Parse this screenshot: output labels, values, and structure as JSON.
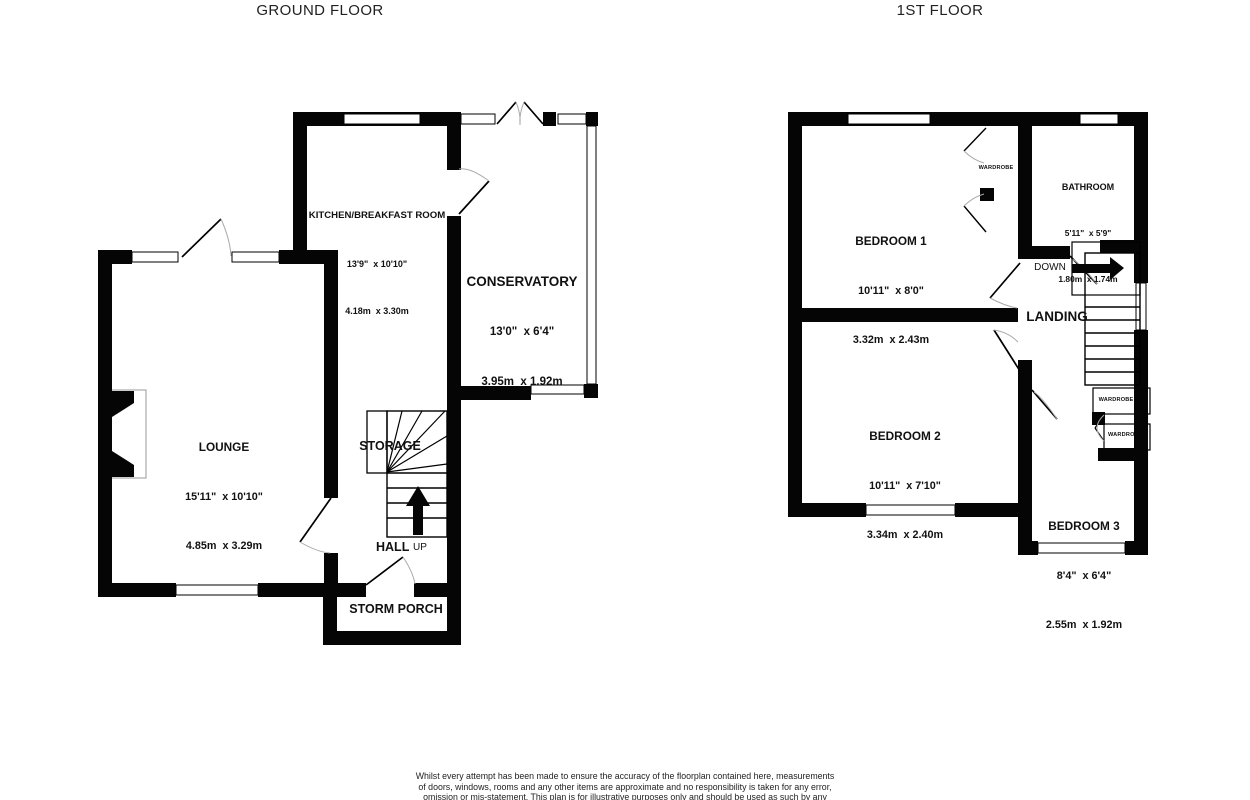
{
  "page": {
    "background": "#ffffff",
    "wall_color": "#000000"
  },
  "titles": {
    "ground": "GROUND FLOOR",
    "first": "1ST FLOOR"
  },
  "rooms": {
    "kitchen": {
      "name": "KITCHEN/BREAKFAST ROOM",
      "imperial": "13'9\"  x 10'10\"",
      "metric": "4.18m  x 3.30m"
    },
    "conservatory": {
      "name": "CONSERVATORY",
      "imperial": "13'0\"  x 6'4\"",
      "metric": "3.95m  x 1.92m"
    },
    "lounge": {
      "name": "LOUNGE",
      "imperial": "15'11\"  x 10'10\"",
      "metric": "4.85m  x 3.29m"
    },
    "bedroom1": {
      "name": "BEDROOM 1",
      "imperial": "10'11\"  x 8'0\"",
      "metric": "3.32m  x 2.43m"
    },
    "bathroom": {
      "name": "BATHROOM",
      "imperial": "5'11\"  x 5'9\"",
      "metric": "1.80m  x 1.74m"
    },
    "bedroom2": {
      "name": "BEDROOM 2",
      "imperial": "10'11\"  x 7'10\"",
      "metric": "3.34m  x 2.40m"
    },
    "bedroom3": {
      "name": "BEDROOM 3",
      "imperial": "8'4\"  x 6'4\"",
      "metric": "2.55m  x 1.92m"
    }
  },
  "labels": {
    "storage": "STORAGE",
    "hall": "HALL",
    "up": "UP",
    "storm_porch": "STORM PORCH",
    "down": "DOWN",
    "landing": "LANDING",
    "wardrobe": "WARDROBE"
  },
  "disclaimer": {
    "line1": "Whilst every attempt has been made to ensure the accuracy of the floorplan contained here, measurements",
    "line2": "of doors, windows, rooms and any other items are approximate and no responsibility is taken for any error,",
    "line3": "omission or mis-statement. This plan is for illustrative purposes only and should be used as such by any"
  }
}
